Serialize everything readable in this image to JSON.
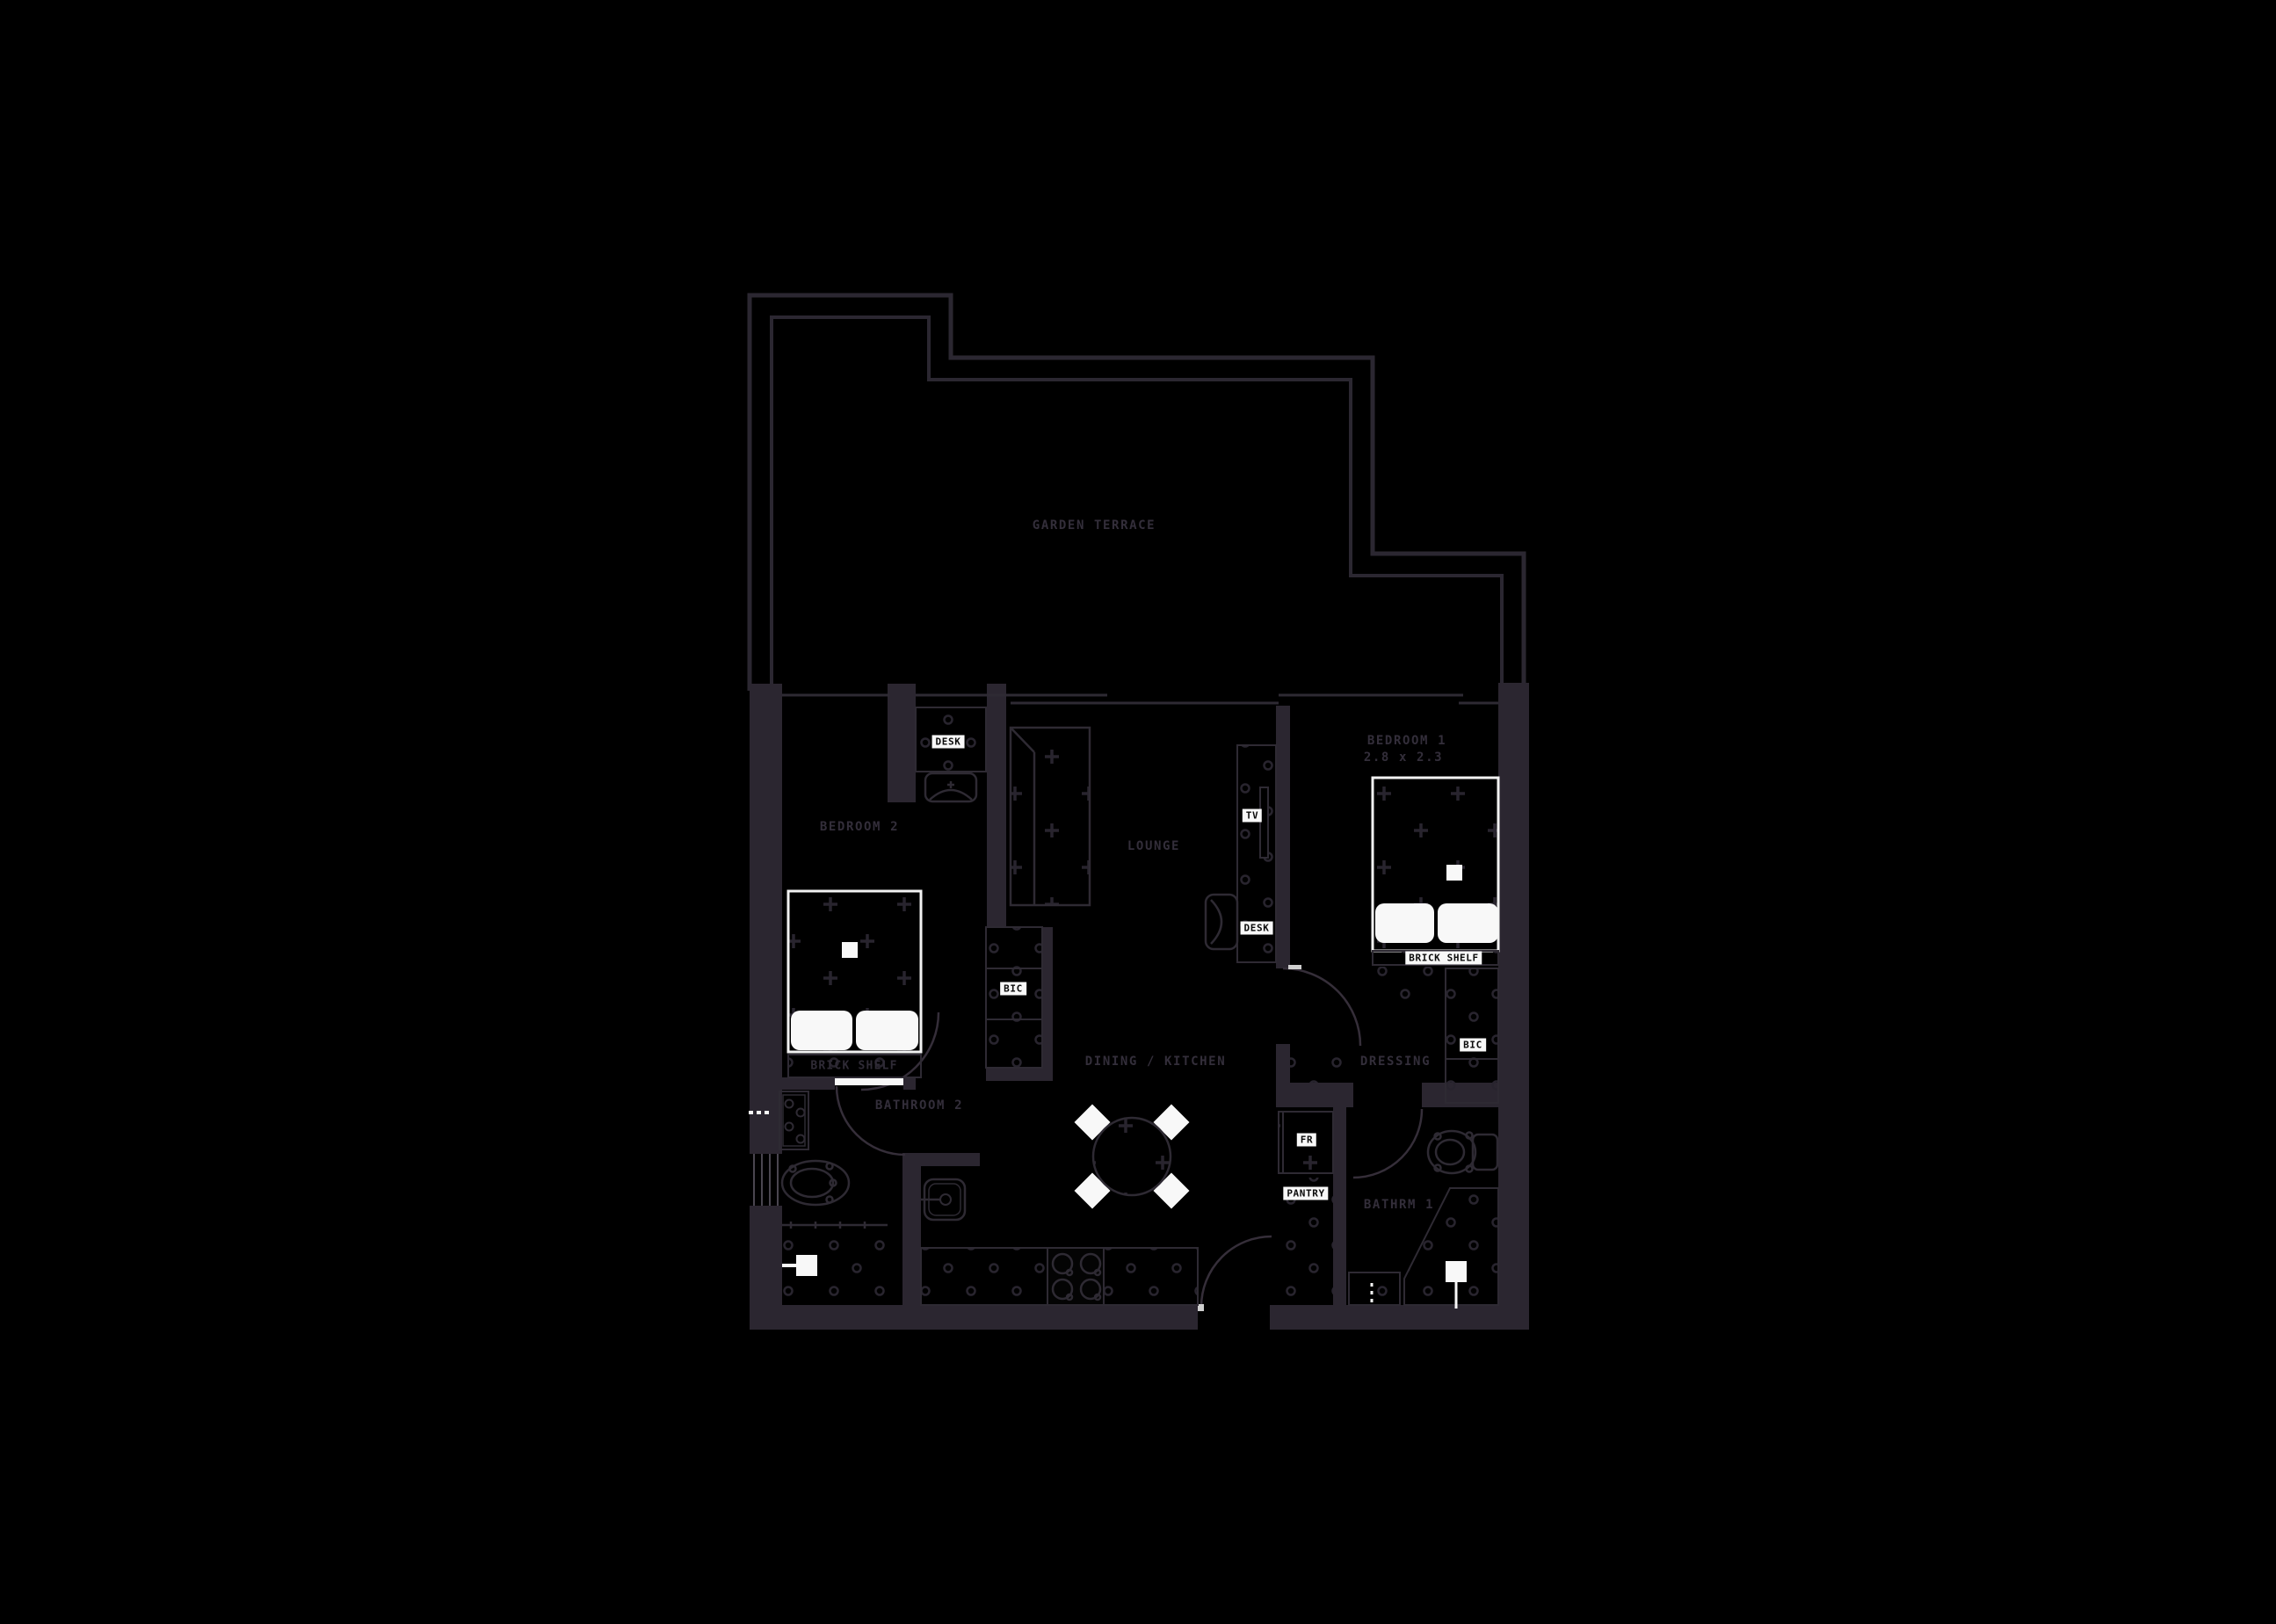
{
  "title": "apartment floor plan",
  "colors": {
    "background": "#000000",
    "wall": "#2b2630",
    "outline": "#2e2a33",
    "pattern": "#28242e",
    "room_text": "#332e3a",
    "tag_bg": "#f8f8f8",
    "tag_text": "#0a0a0a",
    "white_fixture": "#f8f8f8"
  },
  "rooms": {
    "garden_terrace": {
      "label": "GARDEN TERRACE"
    },
    "bedroom_1": {
      "label": "BEDROOM 1",
      "dimensions": "2.8 x 2.3"
    },
    "bedroom_2": {
      "label": "BEDROOM 2"
    },
    "lounge": {
      "label": "LOUNGE"
    },
    "dining_kitchen": {
      "label": "DINING / KITCHEN"
    },
    "dressing": {
      "label": "DRESSING"
    },
    "bathroom_1": {
      "label": "BATHRM 1"
    },
    "bathroom_2": {
      "label": "BATHROOM 2"
    }
  },
  "fixtures": {
    "desk_bedroom_2": "DESK",
    "desk_lounge": "DESK",
    "tv": "TV",
    "bic_hall": "BIC",
    "bic_dressing": "BIC",
    "fridge": "FR",
    "pantry": "PANTRY",
    "brick_shelf_bedroom_1": "BRICK SHELF",
    "brick_shelf_bedroom_2": "BRICK SHELF"
  }
}
